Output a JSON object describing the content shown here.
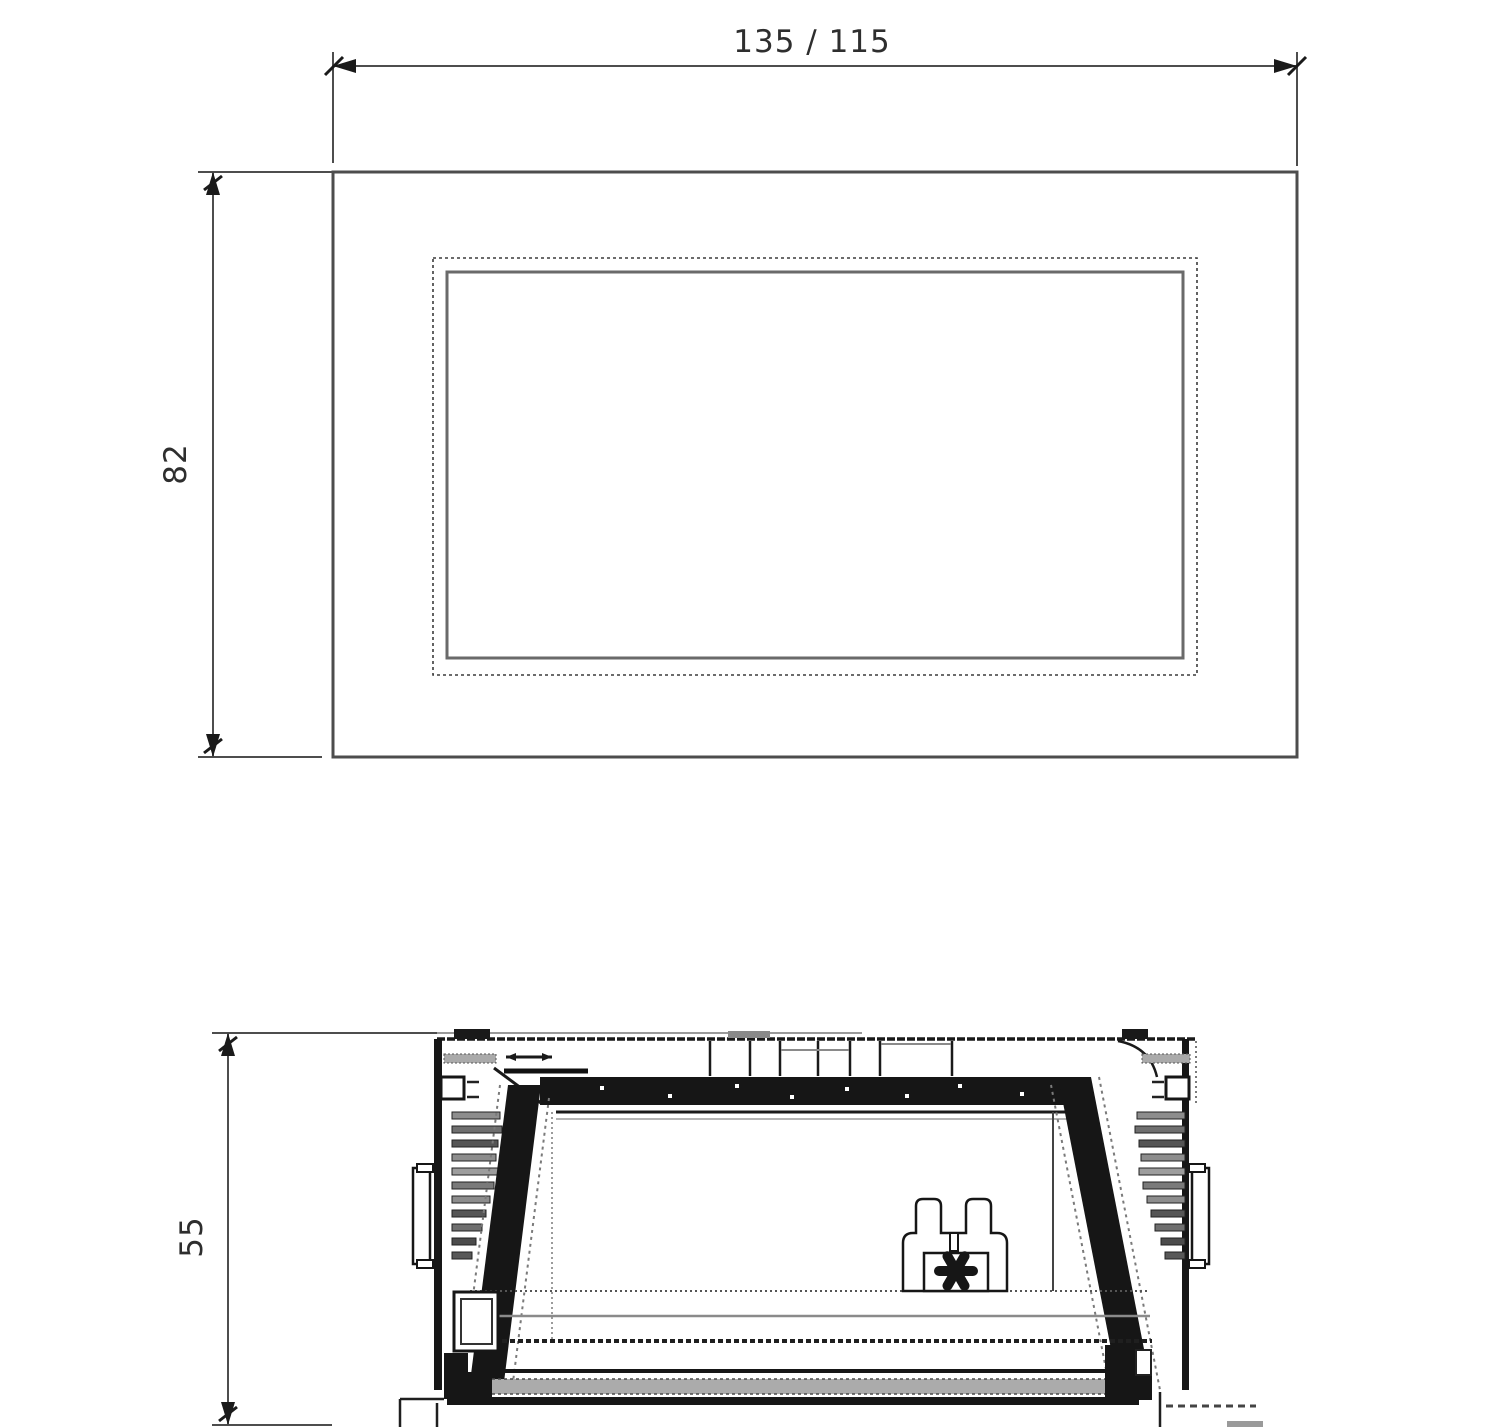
{
  "front_view": {
    "width_label": "135 / 115",
    "height_label": "82"
  },
  "section_view": {
    "depth_label": "55"
  },
  "colors": {
    "line_dark": "#1a1a1a",
    "line_gray": "#6f6f6f",
    "line_light": "#9a9a9a",
    "background": "#ffffff"
  }
}
